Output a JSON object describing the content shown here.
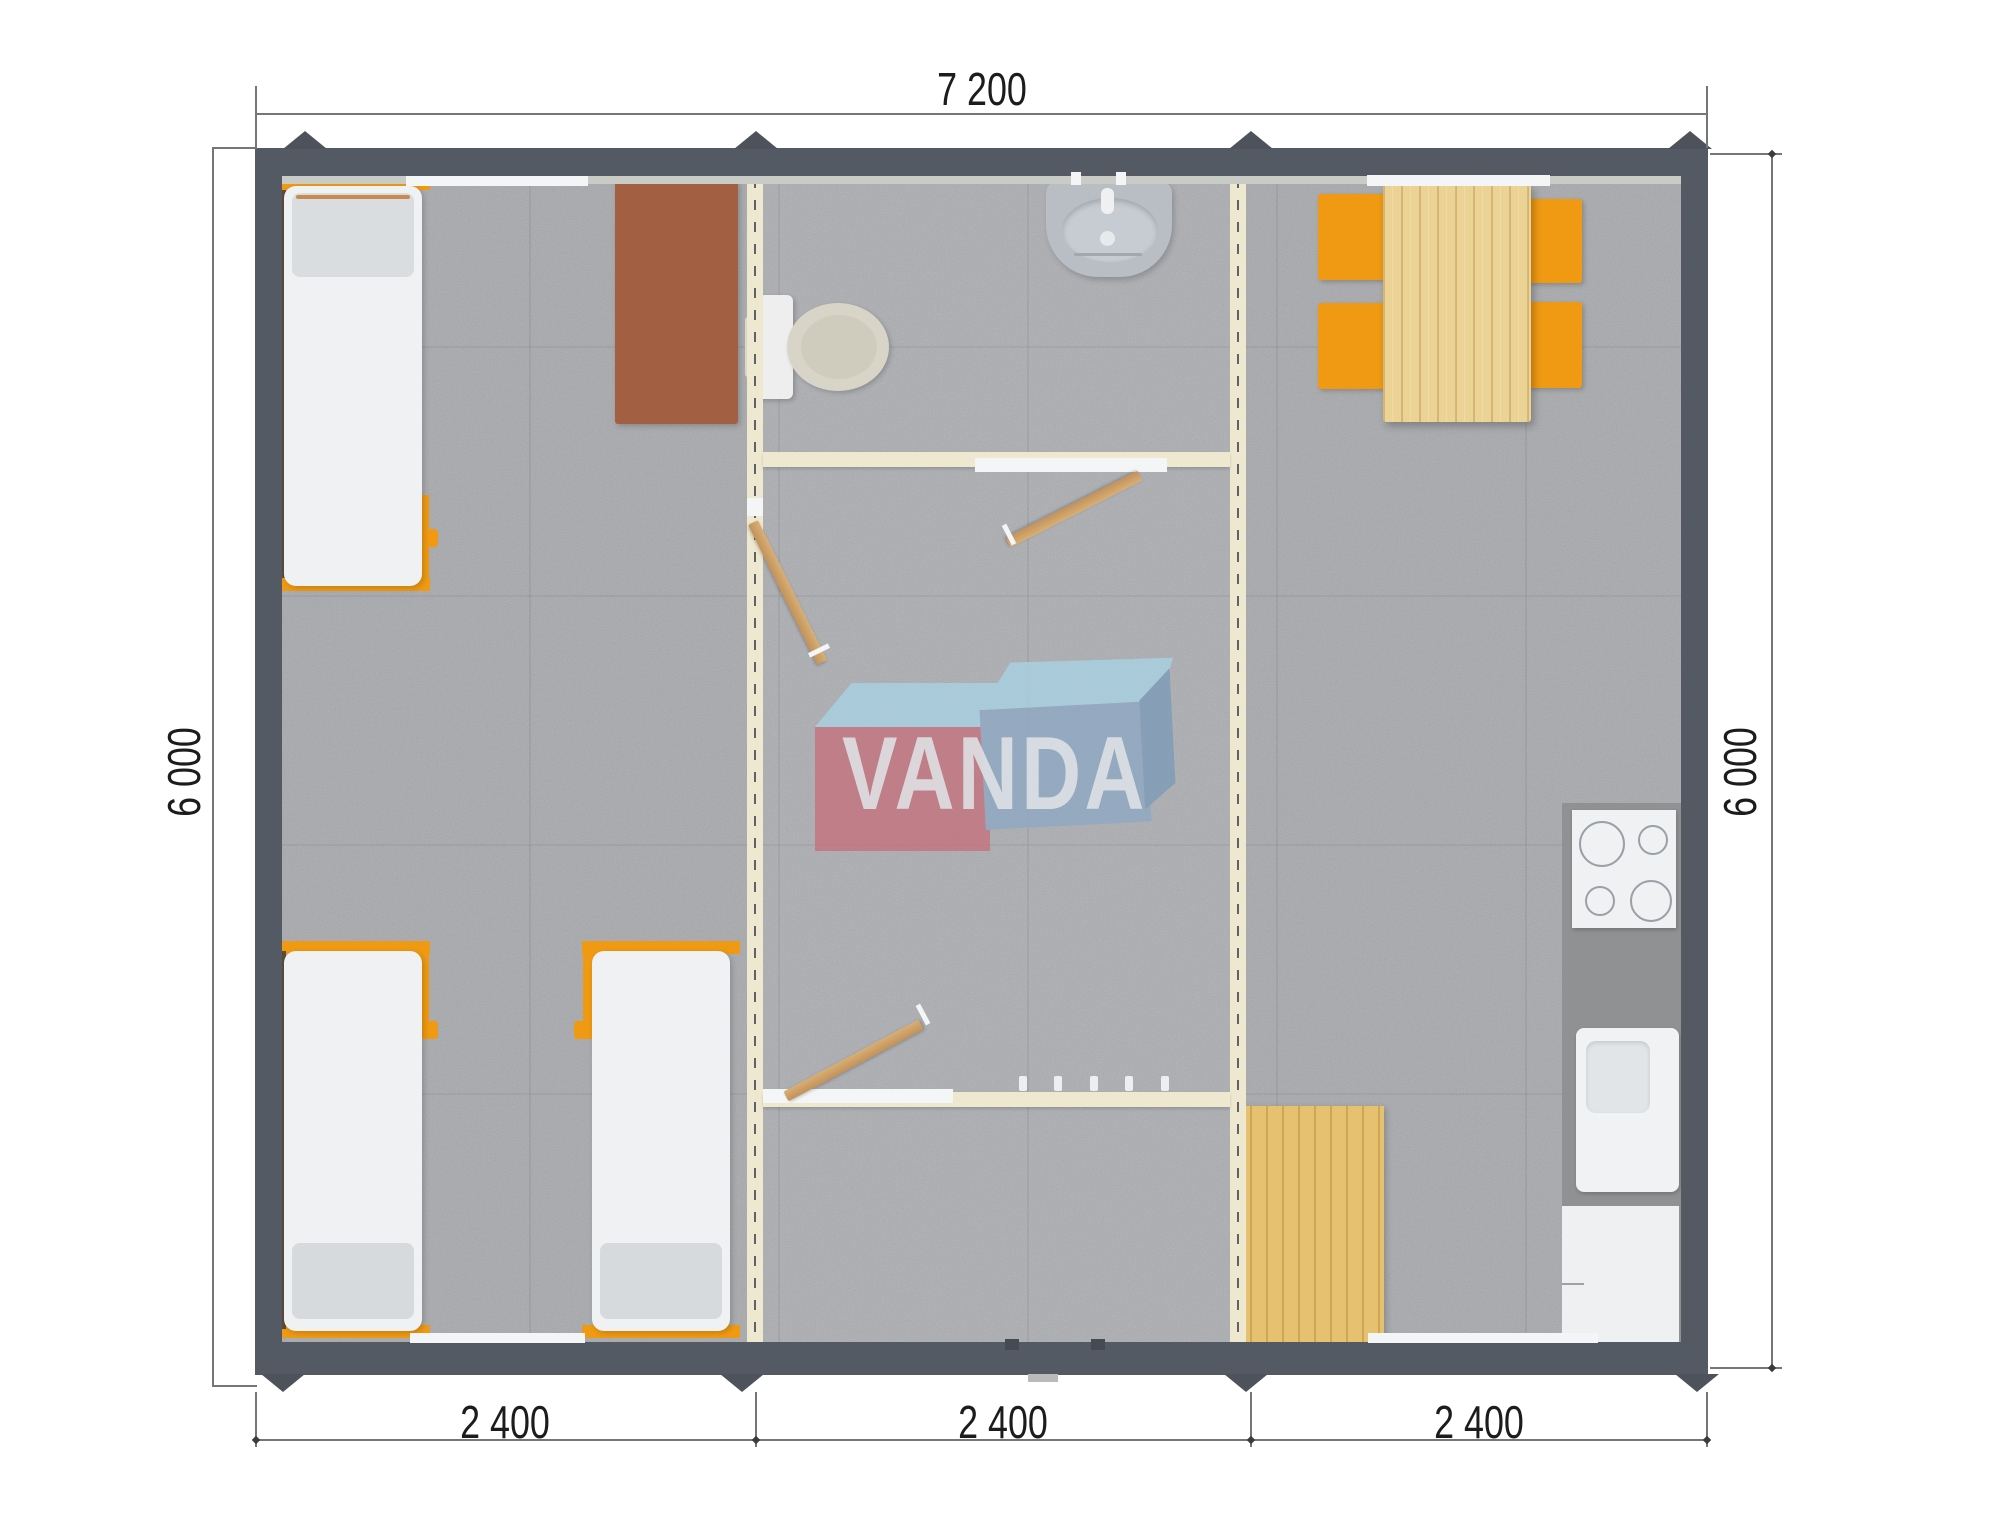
{
  "title": "VANDA modular building floor plan",
  "dimensions": {
    "top": "7 200",
    "left": "6 000",
    "right": "6 000",
    "bottom": [
      "2 400",
      "2 400",
      "2 400"
    ]
  },
  "logo": {
    "text": "VANDA"
  },
  "colors": {
    "wall_frame": "#545a63",
    "floor_carpet": "#a7a8ac",
    "partition_cream": "#efe8d0",
    "accent_orange": "#ef9a12",
    "door_wood": "#cfa368",
    "table_wood": "#ead394",
    "mat_wood": "#e5c170",
    "desk_brown": "#a25f41",
    "fixture_gray": "#b8bec4",
    "counter_gray": "#8f9193",
    "logo_red": "#c4737e",
    "logo_blue": "#8fa9c3",
    "logo_light_blue": "#a9d2e3"
  },
  "rooms": {
    "bedroom": {
      "furniture": [
        "bed",
        "bed",
        "bed",
        "desk"
      ]
    },
    "bathroom": {
      "fixtures": [
        "washbasin",
        "toilet"
      ]
    },
    "hallway": {
      "items": [
        "door",
        "door",
        "door",
        "coat-hooks"
      ]
    },
    "kitchen_dining": {
      "furniture": [
        "dining-table",
        "chair",
        "chair",
        "chair",
        "chair",
        "cooktop",
        "kitchen-sink",
        "base-cabinet",
        "floor-mat"
      ]
    }
  }
}
